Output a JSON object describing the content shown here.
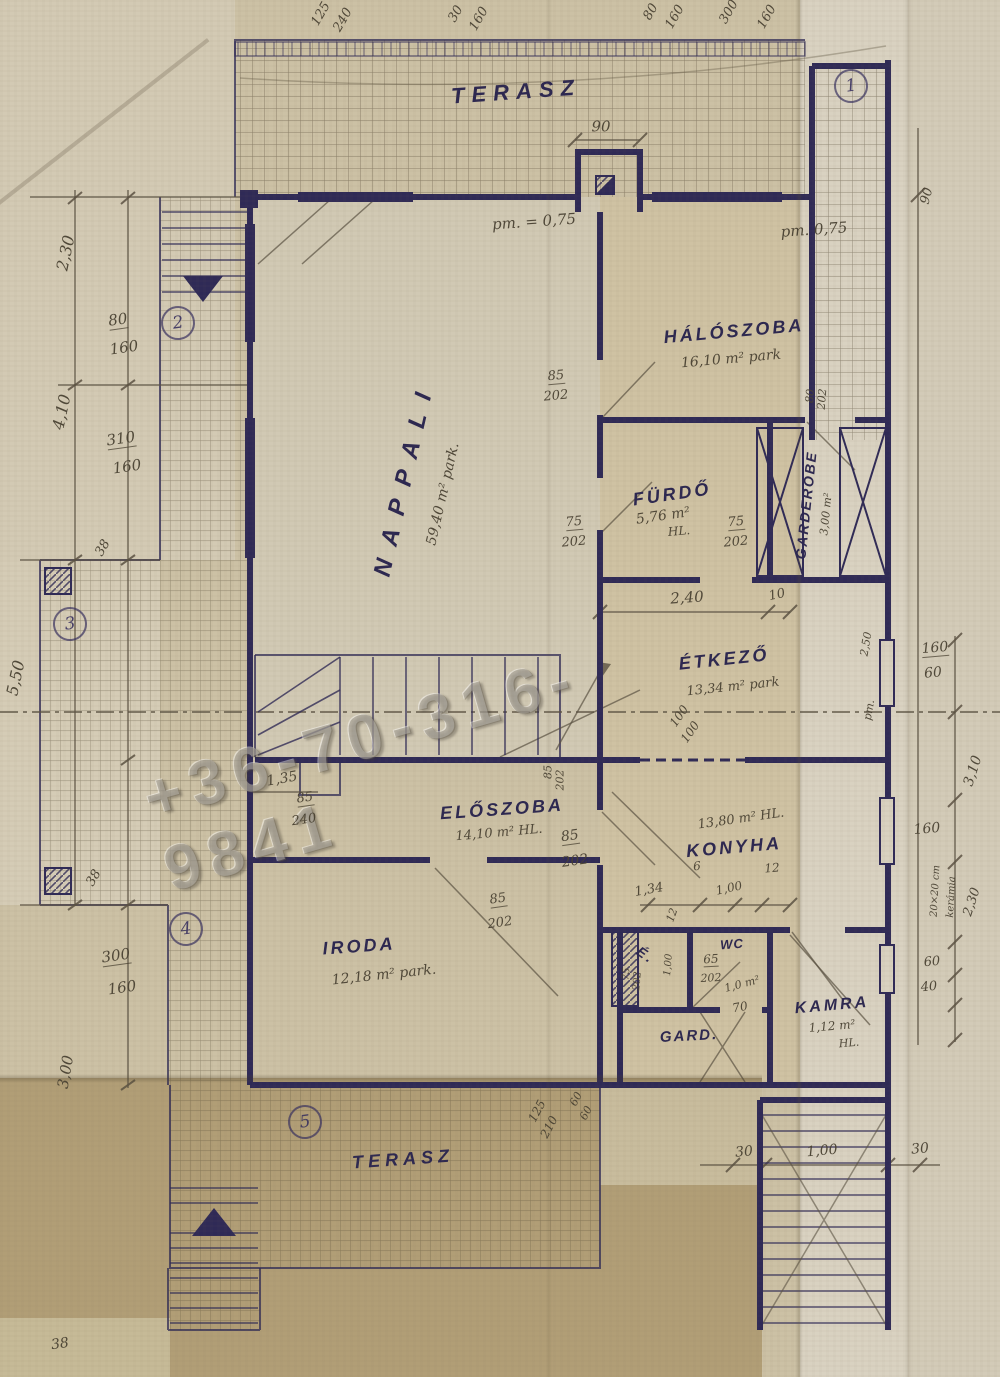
{
  "watermark": {
    "text": "+36-70-316-9841"
  },
  "rooms": [
    {
      "name": "TERASZ",
      "x": 516,
      "y": 92,
      "r": -4,
      "s": 22,
      "sp": 7
    },
    {
      "name": "HÁLÓSZOBA",
      "x": 734,
      "y": 331,
      "r": -5,
      "s": 18,
      "area": "16,10 m² park",
      "ax": 731,
      "ay": 359,
      "ar": -5,
      "as": 14
    },
    {
      "name": "FÜRDŐ",
      "x": 672,
      "y": 494,
      "r": -8,
      "s": 18,
      "area": "5,76 m²",
      "ax": 663,
      "ay": 516,
      "ar": -8,
      "as": 14
    },
    {
      "name": "GARDEROBE",
      "x": 806,
      "y": 505,
      "r": -84,
      "s": 14,
      "sp": 2,
      "area": "3,00 m²",
      "ax": 826,
      "ay": 514,
      "ar": -84,
      "as": 11
    },
    {
      "name": "NAPPALI",
      "x": 405,
      "y": 478,
      "r": -77,
      "s": 24,
      "sp": 14,
      "area": "59,40 m² park.",
      "ax": 443,
      "ay": 494,
      "ar": -77,
      "as": 14
    },
    {
      "name": "ÉTKEZŐ",
      "x": 724,
      "y": 659,
      "r": -6,
      "s": 18,
      "area": "13,34 m² park",
      "ax": 733,
      "ay": 687,
      "ar": -6,
      "as": 13
    },
    {
      "name": "ELŐSZOBA",
      "x": 502,
      "y": 809,
      "r": -4,
      "s": 18,
      "area": "14,10 m² HL.",
      "ax": 499,
      "ay": 833,
      "ar": -5,
      "as": 13
    },
    {
      "name": "KONYHA",
      "x": 734,
      "y": 847,
      "r": -5,
      "s": 18,
      "area": "13,80 m² HL.",
      "ax": 741,
      "ay": 819,
      "ar": -8,
      "as": 13
    },
    {
      "name": "IRODA",
      "x": 359,
      "y": 946,
      "r": -4,
      "s": 18,
      "area": "12,18 m² park.",
      "ax": 384,
      "ay": 975,
      "ar": -6,
      "as": 14
    },
    {
      "name": "WC",
      "x": 732,
      "y": 944,
      "r": -4,
      "s": 13,
      "sp": 1
    },
    {
      "name": "GARD.",
      "x": 689,
      "y": 1036,
      "r": -3,
      "s": 15,
      "sp": 2
    },
    {
      "name": "KAMRA",
      "x": 832,
      "y": 1006,
      "r": -5,
      "s": 16,
      "area": "1,12 m²",
      "ax": 832,
      "ay": 1026,
      "ar": -5,
      "as": 12
    },
    {
      "name": "TERASZ",
      "x": 403,
      "y": 1159,
      "r": -4,
      "s": 18,
      "sp": 5
    }
  ],
  "dims": [
    {
      "t": "125",
      "x": 321,
      "y": 14,
      "r": -60,
      "s": 13
    },
    {
      "t": "240",
      "x": 343,
      "y": 20,
      "r": -60,
      "s": 13
    },
    {
      "t": "30",
      "x": 456,
      "y": 14,
      "r": -60,
      "s": 13
    },
    {
      "t": "160",
      "x": 479,
      "y": 19,
      "r": -60,
      "s": 13
    },
    {
      "t": "80",
      "x": 651,
      "y": 12,
      "r": -60,
      "s": 13
    },
    {
      "t": "160",
      "x": 675,
      "y": 17,
      "r": -60,
      "s": 13
    },
    {
      "t": "300",
      "x": 729,
      "y": 12,
      "r": -60,
      "s": 13
    },
    {
      "t": "160",
      "x": 767,
      "y": 17,
      "r": -60,
      "s": 13
    },
    {
      "t": "90",
      "x": 601,
      "y": 127,
      "r": 0,
      "s": 15
    },
    {
      "t": "pm. = 0,75",
      "x": 534,
      "y": 222,
      "r": -4,
      "s": 15
    },
    {
      "t": "pm. 0,75",
      "x": 814,
      "y": 230,
      "r": -4,
      "s": 15
    },
    {
      "t": "90",
      "x": 927,
      "y": 196,
      "r": -75,
      "s": 13
    },
    {
      "t": "2,30",
      "x": 66,
      "y": 253,
      "r": -78,
      "s": 16
    },
    {
      "t": "80",
      "x": 118,
      "y": 321,
      "r": -8,
      "s": 15,
      "c": "pencil frac"
    },
    {
      "t": "160",
      "x": 124,
      "y": 348,
      "r": -8,
      "s": 15
    },
    {
      "t": "4,10",
      "x": 62,
      "y": 412,
      "r": -78,
      "s": 16
    },
    {
      "t": "310",
      "x": 121,
      "y": 440,
      "r": -8,
      "s": 15,
      "c": "pencil frac"
    },
    {
      "t": "160",
      "x": 127,
      "y": 467,
      "r": -8,
      "s": 15
    },
    {
      "t": "38",
      "x": 103,
      "y": 548,
      "r": -60,
      "s": 13
    },
    {
      "t": "5,50",
      "x": 16,
      "y": 678,
      "r": -78,
      "s": 16
    },
    {
      "t": "38",
      "x": 94,
      "y": 878,
      "r": -60,
      "s": 13
    },
    {
      "t": "300",
      "x": 116,
      "y": 957,
      "r": -8,
      "s": 15,
      "c": "pencil frac"
    },
    {
      "t": "160",
      "x": 122,
      "y": 988,
      "r": -8,
      "s": 15
    },
    {
      "t": "3,00",
      "x": 66,
      "y": 1072,
      "r": -80,
      "s": 15
    },
    {
      "t": "38",
      "x": 60,
      "y": 1344,
      "r": -8,
      "s": 14
    },
    {
      "t": "85",
      "x": 556,
      "y": 377,
      "r": -5,
      "s": 13,
      "c": "pencil frac"
    },
    {
      "t": "202",
      "x": 556,
      "y": 396,
      "r": -5,
      "s": 13
    },
    {
      "t": "75",
      "x": 574,
      "y": 523,
      "r": -5,
      "s": 13,
      "c": "pencil frac"
    },
    {
      "t": "202",
      "x": 574,
      "y": 542,
      "r": -5,
      "s": 13
    },
    {
      "t": "75",
      "x": 736,
      "y": 523,
      "r": -5,
      "s": 13,
      "c": "pencil frac"
    },
    {
      "t": "202",
      "x": 736,
      "y": 542,
      "r": -5,
      "s": 13
    },
    {
      "t": "2,40",
      "x": 687,
      "y": 598,
      "r": -4,
      "s": 15
    },
    {
      "t": "10",
      "x": 777,
      "y": 595,
      "r": -12,
      "s": 13
    },
    {
      "t": "80",
      "x": 810,
      "y": 396,
      "r": -85,
      "s": 11
    },
    {
      "t": "202",
      "x": 822,
      "y": 399,
      "r": -85,
      "s": 11
    },
    {
      "t": "100",
      "x": 679,
      "y": 716,
      "r": -55,
      "s": 12
    },
    {
      "t": "100",
      "x": 690,
      "y": 732,
      "r": -55,
      "s": 12
    },
    {
      "t": "2,50",
      "x": 866,
      "y": 644,
      "r": -80,
      "s": 11
    },
    {
      "t": "pm.",
      "x": 869,
      "y": 710,
      "r": -80,
      "s": 11
    },
    {
      "t": "1,35",
      "x": 282,
      "y": 779,
      "r": -10,
      "s": 14
    },
    {
      "t": "85",
      "x": 305,
      "y": 799,
      "r": -8,
      "s": 13,
      "c": "pencil frac"
    },
    {
      "t": "240",
      "x": 304,
      "y": 820,
      "r": -8,
      "s": 13
    },
    {
      "t": "85",
      "x": 548,
      "y": 772,
      "r": -90,
      "s": 11
    },
    {
      "t": "202",
      "x": 560,
      "y": 780,
      "r": -90,
      "s": 11
    },
    {
      "t": "85",
      "x": 570,
      "y": 837,
      "r": -8,
      "s": 14,
      "c": "pencil frac"
    },
    {
      "t": "202",
      "x": 575,
      "y": 861,
      "r": -8,
      "s": 14
    },
    {
      "t": "85",
      "x": 498,
      "y": 900,
      "r": -8,
      "s": 13,
      "c": "pencil frac"
    },
    {
      "t": "202",
      "x": 500,
      "y": 923,
      "r": -8,
      "s": 13
    },
    {
      "t": "1,34",
      "x": 649,
      "y": 890,
      "r": -10,
      "s": 13
    },
    {
      "t": "6",
      "x": 697,
      "y": 866,
      "r": -5,
      "s": 12
    },
    {
      "t": "12",
      "x": 772,
      "y": 868,
      "r": -5,
      "s": 12
    },
    {
      "t": "1,00",
      "x": 729,
      "y": 888,
      "r": -12,
      "s": 12
    },
    {
      "t": "12",
      "x": 672,
      "y": 915,
      "r": -70,
      "s": 11
    },
    {
      "t": "É.",
      "x": 646,
      "y": 955,
      "r": 35,
      "s": 14,
      "c": "ink"
    },
    {
      "t": "75",
      "x": 627,
      "y": 974,
      "r": -85,
      "s": 10
    },
    {
      "t": "202",
      "x": 638,
      "y": 981,
      "r": -85,
      "s": 10
    },
    {
      "t": "1,00",
      "x": 669,
      "y": 965,
      "r": -85,
      "s": 10
    },
    {
      "t": "65",
      "x": 711,
      "y": 960,
      "r": -3,
      "s": 12,
      "c": "pencil frac"
    },
    {
      "t": "202",
      "x": 711,
      "y": 978,
      "r": -3,
      "s": 11
    },
    {
      "t": "1,0 m²",
      "x": 742,
      "y": 984,
      "r": -15,
      "s": 11
    },
    {
      "t": "70",
      "x": 740,
      "y": 1007,
      "r": -10,
      "s": 12
    },
    {
      "t": "HL.",
      "x": 679,
      "y": 531,
      "r": -5,
      "s": 12
    },
    {
      "t": "HL.",
      "x": 849,
      "y": 1043,
      "r": -5,
      "s": 11
    },
    {
      "t": "160",
      "x": 935,
      "y": 649,
      "r": -5,
      "s": 14,
      "c": "pencil frac"
    },
    {
      "t": "60",
      "x": 933,
      "y": 673,
      "r": -5,
      "s": 14
    },
    {
      "t": "3,10",
      "x": 973,
      "y": 771,
      "r": -72,
      "s": 14
    },
    {
      "t": "160",
      "x": 927,
      "y": 829,
      "r": -5,
      "s": 14
    },
    {
      "t": "20×20 cm",
      "x": 936,
      "y": 891,
      "r": -87,
      "s": 10
    },
    {
      "t": "kerámia",
      "x": 952,
      "y": 897,
      "r": -87,
      "s": 10
    },
    {
      "t": "2,30",
      "x": 972,
      "y": 902,
      "r": -72,
      "s": 13
    },
    {
      "t": "60",
      "x": 932,
      "y": 962,
      "r": -5,
      "s": 13
    },
    {
      "t": "40",
      "x": 929,
      "y": 987,
      "r": -5,
      "s": 13
    },
    {
      "t": "30",
      "x": 744,
      "y": 1152,
      "r": -5,
      "s": 14
    },
    {
      "t": "1,00",
      "x": 822,
      "y": 1151,
      "r": -5,
      "s": 14
    },
    {
      "t": "30",
      "x": 920,
      "y": 1149,
      "r": -5,
      "s": 14
    },
    {
      "t": "125",
      "x": 537,
      "y": 1111,
      "r": -62,
      "s": 12
    },
    {
      "t": "210",
      "x": 549,
      "y": 1127,
      "r": -62,
      "s": 12
    },
    {
      "t": "60",
      "x": 576,
      "y": 1099,
      "r": -62,
      "s": 11
    },
    {
      "t": "60",
      "x": 586,
      "y": 1113,
      "r": -62,
      "s": 11
    }
  ],
  "markers": [
    {
      "n": "1",
      "x": 849,
      "y": 84
    },
    {
      "n": "2",
      "x": 176,
      "y": 321
    },
    {
      "n": "3",
      "x": 68,
      "y": 622
    },
    {
      "n": "4",
      "x": 184,
      "y": 927
    },
    {
      "n": "5",
      "x": 303,
      "y": 1120
    }
  ]
}
